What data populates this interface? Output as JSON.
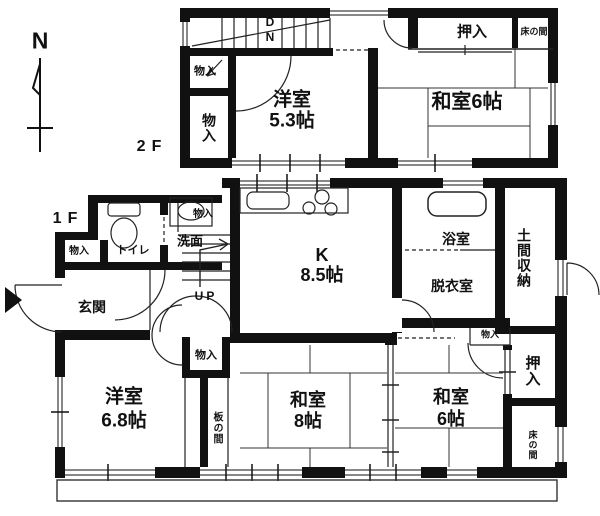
{
  "compass": {
    "north_label": "N"
  },
  "floor2": {
    "floor_label": "2F",
    "stairs_down_label": "DN",
    "closet_by_stairs": "物入",
    "closet_left": "物入",
    "western_room_name": "洋室",
    "western_room_size": "5.3帖",
    "closet_oshiire": "押入",
    "tokonoma": "床の間",
    "japanese_room": "和室6帖"
  },
  "floor1": {
    "floor_label": "1F",
    "toilet": "トイレ",
    "washroom": "洗面",
    "closet_by_washroom": "物入",
    "closet_by_entrance": "物入",
    "entrance": "玄関",
    "stairs_up_label": "UP",
    "kitchen_name": "K",
    "kitchen_size": "8.5帖",
    "bathroom": "浴室",
    "dressing_room": "脱衣室",
    "earthen_storage": "土間収納",
    "closet_hall": "物入",
    "closet_small": "物入",
    "closet_oshiire": "押入",
    "tokonoma": "床の間",
    "japanese_room8_name": "和室",
    "japanese_room8_size": "8帖",
    "japanese_room6_name": "和室",
    "japanese_room6_size": "6帖",
    "wooden_floor_strip": "板の間",
    "western_room_name": "洋室",
    "western_room_size": "6.8帖"
  },
  "colors": {
    "wall": "#111111",
    "line": "#333333",
    "bg": "#ffffff"
  }
}
